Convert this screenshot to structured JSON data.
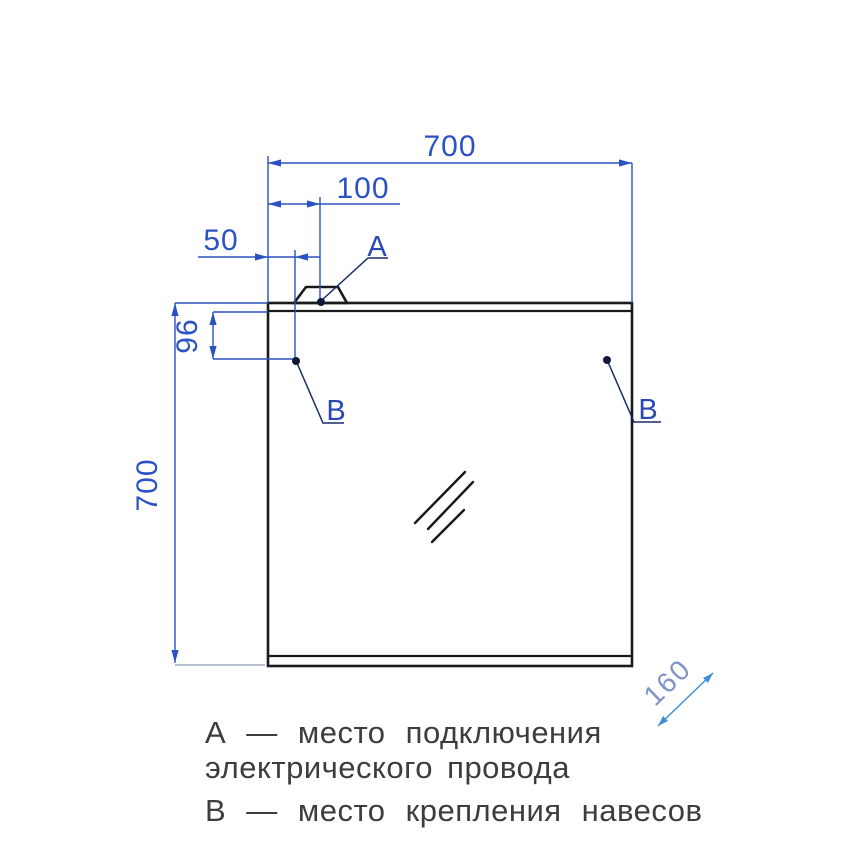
{
  "drawing": {
    "dimensions": {
      "top_width": "700",
      "a_offset": "100",
      "b_offset": "50",
      "b_vertical_offset": "96",
      "left_height": "700",
      "depth": "160"
    },
    "markers": {
      "a": "А",
      "b": "В"
    },
    "legend": {
      "line_a_1": "А — место подключения",
      "line_a_2": "электрического провода",
      "line_b": "В — место крепления навесов"
    },
    "colors": {
      "dimension_blue": "#2b52c4",
      "leader_navy": "#1b2a6b",
      "dot_navy": "#0e1838",
      "depth_arrow_blue": "#3e8fd8",
      "depth_text_blue": "#8093c8",
      "outline_black": "#1a1a1a",
      "legend_gray": "#3d3d3d",
      "extension_gray": "#9fadbd"
    }
  }
}
